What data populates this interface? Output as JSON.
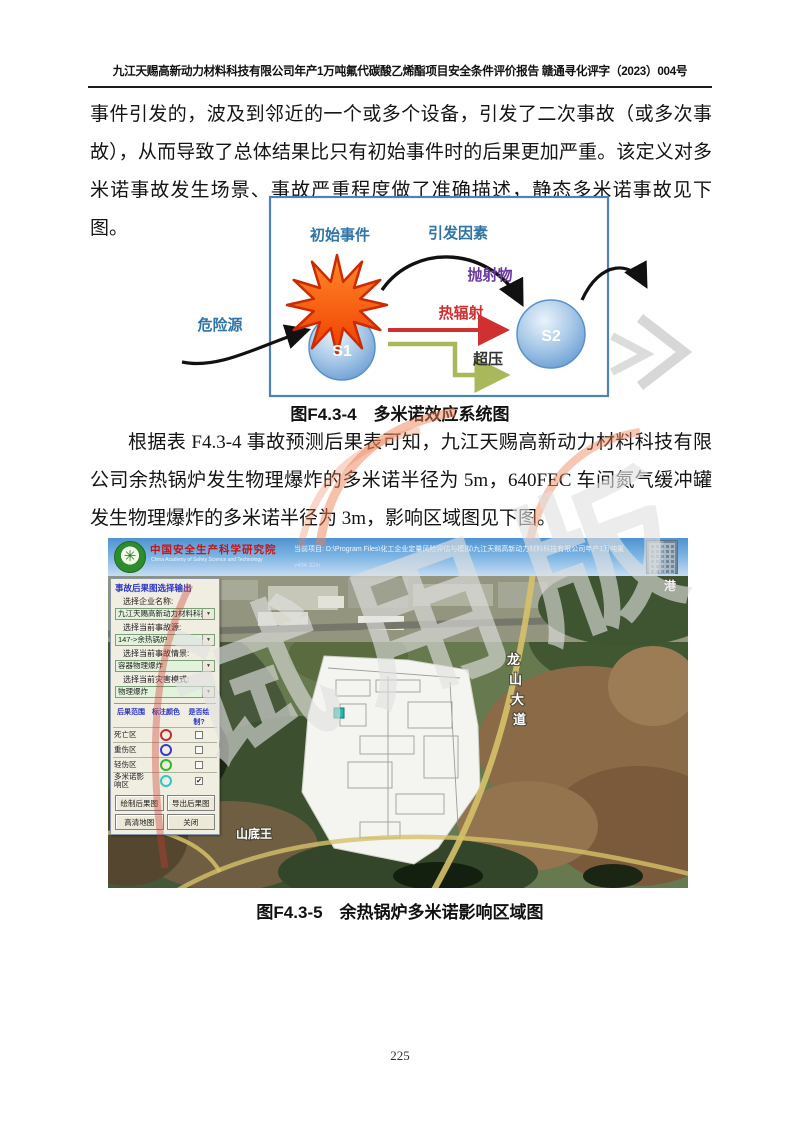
{
  "page": {
    "number": "225"
  },
  "header": {
    "title": "九江天赐高新动力材料科技有限公司年产1万吨氟代碳酸乙烯酯项目安全条件评价报告  赣通寻化评字（2023）004号"
  },
  "paragraphs": {
    "p1": "事件引发的，波及到邻近的一个或多个设备，引发了二次事故（或多次事故），从而导致了总体结果比只有初始事件时的后果更加严重。该定义对多米诺事故发生场景、事故严重程度做了准确描述，静态多米诺事故见下图。",
    "p2": "根据表 F4.3-4 事故预测后果表可知，九江天赐高新动力材料科技有限公司余热锅炉发生物理爆炸的多米诺半径为 5m，640FEC 车间氮气缓冲罐发生物理爆炸的多米诺半径为 3m，影响区域图见下图。"
  },
  "figure1": {
    "caption": "图F4.3-4　多米诺效应系统图",
    "labels": {
      "initial_event": "初始事件",
      "trigger_factor": "引发因素",
      "projectile": "抛射物",
      "heat_radiation": "热辐射",
      "overpressure": "超压",
      "hazard_source": "危险源",
      "s1": "S1",
      "s2": "S2"
    }
  },
  "figure2": {
    "caption": "图F4.3-5　余热锅炉多米诺影响区域图",
    "app": {
      "org_cn": "中国安全生产科学研究院",
      "org_en": "China Academy of Safety Science and Technology",
      "project_path": "当前项目: D:\\Program Files\\化工企业定量风险评估与模拟\\九江天赐高新动力材料科技有限公司年产1万吨氟代碳酸乙烯酯项目",
      "project_sub": "v404 32in",
      "panel": {
        "title": "事故后果图选择输出",
        "fields": [
          {
            "label": "选择企业名称:",
            "value": "九江天赐高新动力材料科技有限公"
          },
          {
            "label": "选择当前事故源:",
            "value": "147->余热锅炉"
          },
          {
            "label": "选择当前事故情景:",
            "value": "容器物理爆炸"
          },
          {
            "label": "选择当前灾害模式:",
            "value": "物理爆炸"
          }
        ],
        "table": {
          "headers": [
            "后果范围",
            "标注颜色",
            "是否绘制?"
          ],
          "rows": [
            {
              "label": "死亡区",
              "color": "#cc2a2a",
              "check": ""
            },
            {
              "label": "重伤区",
              "color": "#3a3acc",
              "check": ""
            },
            {
              "label": "轻伤区",
              "color": "#2abb2a",
              "check": ""
            },
            {
              "label": "多米诺影响区",
              "color": "#2ac8c8",
              "check": "✔"
            }
          ]
        },
        "buttons": [
          "绘制后果图",
          "导出后果图",
          "高清地图",
          "关闭"
        ]
      }
    },
    "map": {
      "road_chars": [
        "龙",
        "山",
        "大",
        "道"
      ],
      "village": "山底王",
      "corner": "港"
    }
  },
  "watermark": {
    "text": "试用版"
  },
  "colors": {
    "diagram_border": "#4f81bd",
    "heat_arrow_red": "#d03030",
    "overpressure_olive": "#a9b85a",
    "projectile_purple": "#6a3aa0",
    "explosion_orange": "#f25518",
    "node_blue": "#7fb0e0",
    "panel_title_blue": "#2a35c8"
  }
}
